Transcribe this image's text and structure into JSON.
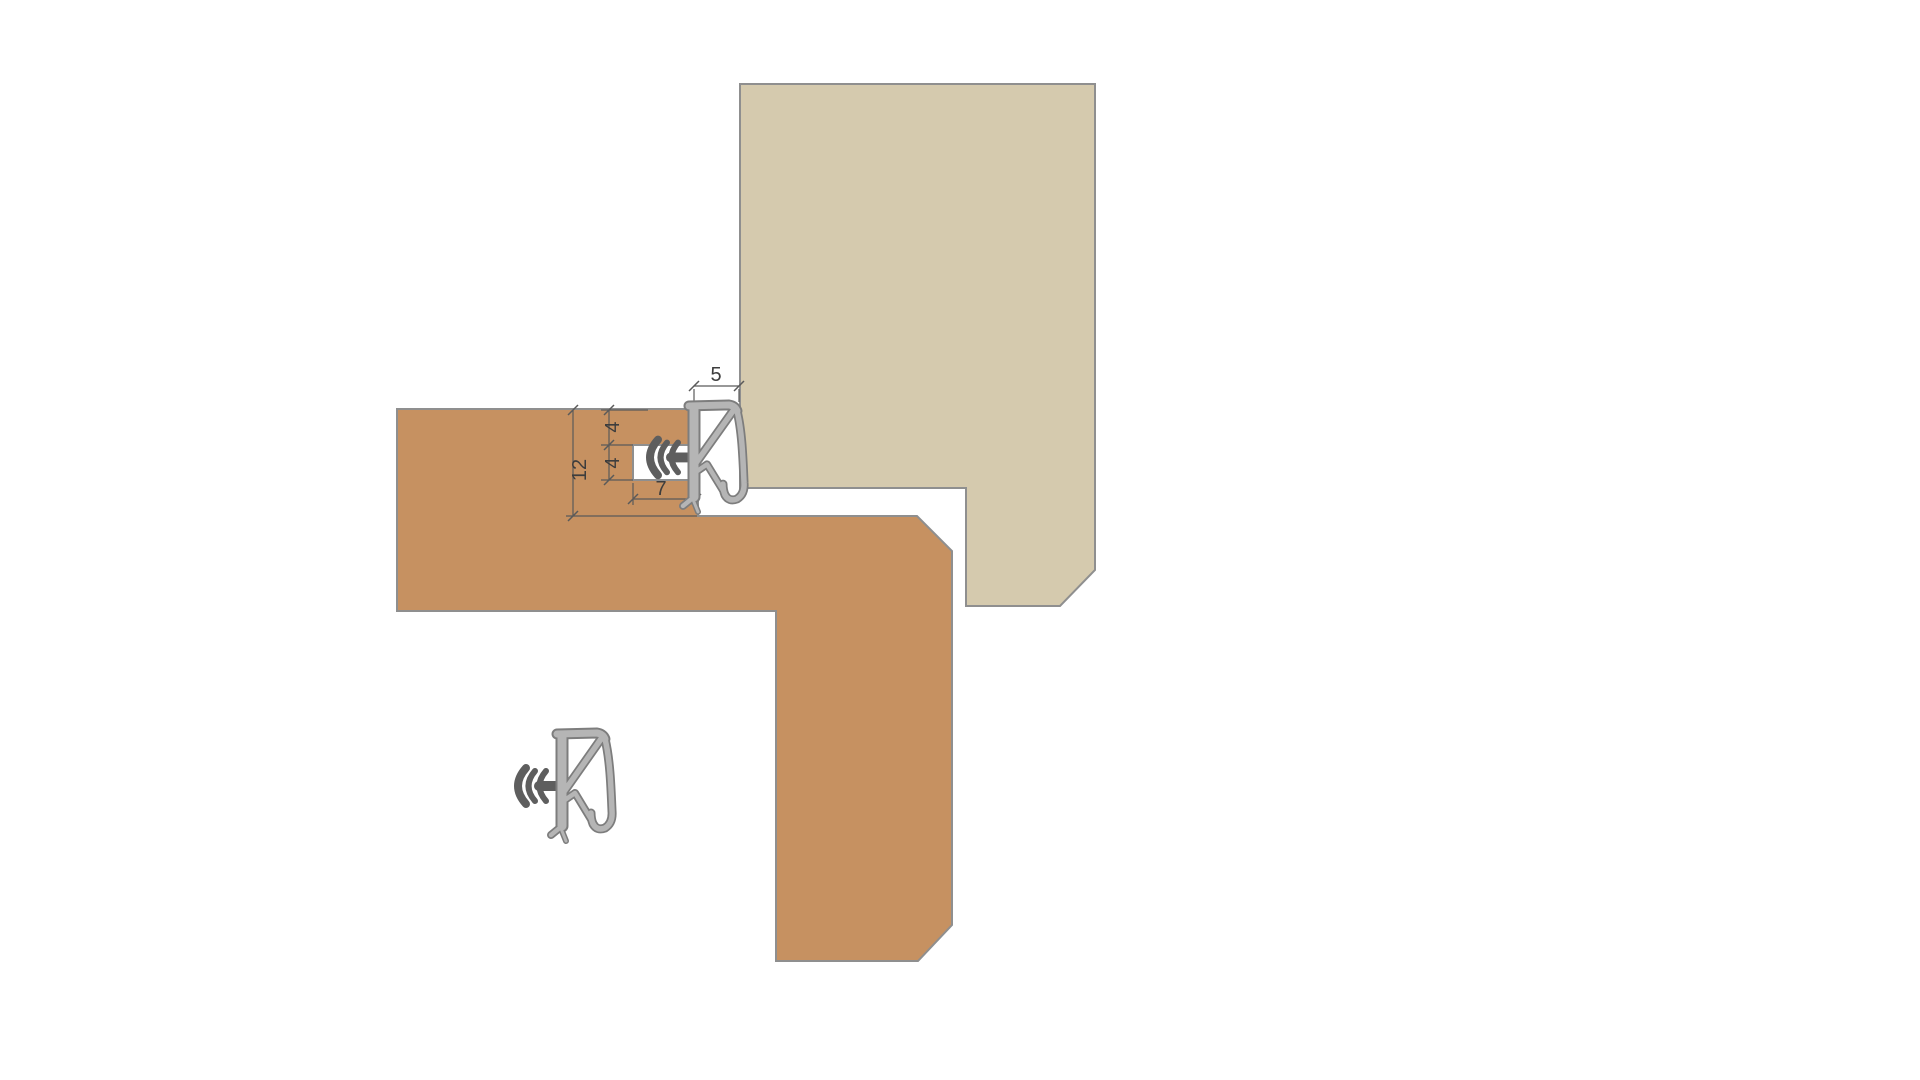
{
  "diagram": {
    "description": "Cross-section detail of a weatherseal profile fitted into a grooved timber frame rebate against a door leaf, shown installed (top) and in free state (bottom left)",
    "dimensions": {
      "seal_width": "5",
      "groove_top_offset": "4",
      "groove_height": "4",
      "rebate_depth": "12",
      "groove_depth": "7"
    },
    "parts": {
      "frame": "timber frame section",
      "door": "door leaf section",
      "seal_installed": "weatherseal installed in groove",
      "seal_free": "weatherseal free state",
      "anchor": "barbed anchor stem"
    },
    "colors": {
      "frame_fill": "#c69161",
      "door_fill": "#d5caae",
      "shape_outline": "#8f8f8f",
      "seal_fill": "#b5b5b5",
      "seal_outline": "#7d7d7d",
      "anchor_fill": "#5e5e5e",
      "dimension_line": "#5a5a5a",
      "dimension_text": "#3d3d3d",
      "background": "#ffffff"
    }
  }
}
